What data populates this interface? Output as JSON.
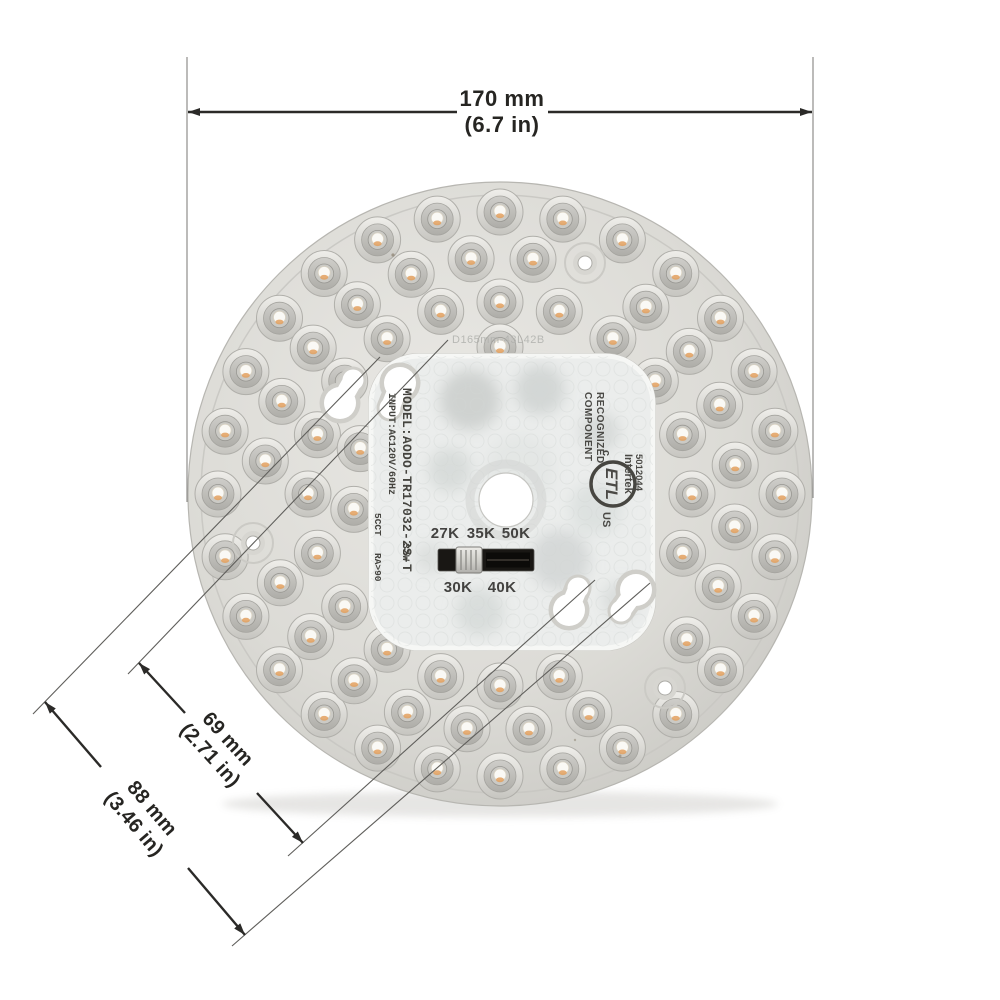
{
  "figure": {
    "type": "product-dimension-diagram",
    "subject": "round LED ceiling light module, top view"
  },
  "dimensions": {
    "diameter_mm": "170 mm",
    "diameter_in": "(6.7 in)",
    "inner_hole_spacing_mm": "69 mm",
    "inner_hole_spacing_in": "(2.71 in)",
    "outer_hole_spacing_mm": "88 mm",
    "outer_hole_spacing_in": "(3.46 in)"
  },
  "markings": {
    "model": "MODEL:AODO-TR17032-2S-T",
    "input": "INPUT:AC120V/60Hz",
    "wattage": "32W",
    "cct": "5CCT",
    "cri": "RA>90",
    "diffuser_print": "D165mm-43L42B"
  },
  "etl": {
    "recognized": "RECOGNIZED",
    "component": "COMPONENT",
    "c": "c",
    "logo": "ETL",
    "us": "US",
    "intertek": "Intertek",
    "number": "5012044"
  },
  "cct_switch": {
    "top_labels": [
      "27K",
      "35K",
      "50K"
    ],
    "bottom_labels": [
      "30K",
      "40K"
    ],
    "selected": "30K"
  },
  "colors": {
    "body": "#d9d8d3",
    "lens_rim": "#e7e6e2",
    "lens_inner": "#c2c1bc",
    "chip": "#faf9f5",
    "phosphor": "#e2a05e",
    "pcb_area": "#ebedec",
    "dimension_line": "#2b2a28"
  }
}
